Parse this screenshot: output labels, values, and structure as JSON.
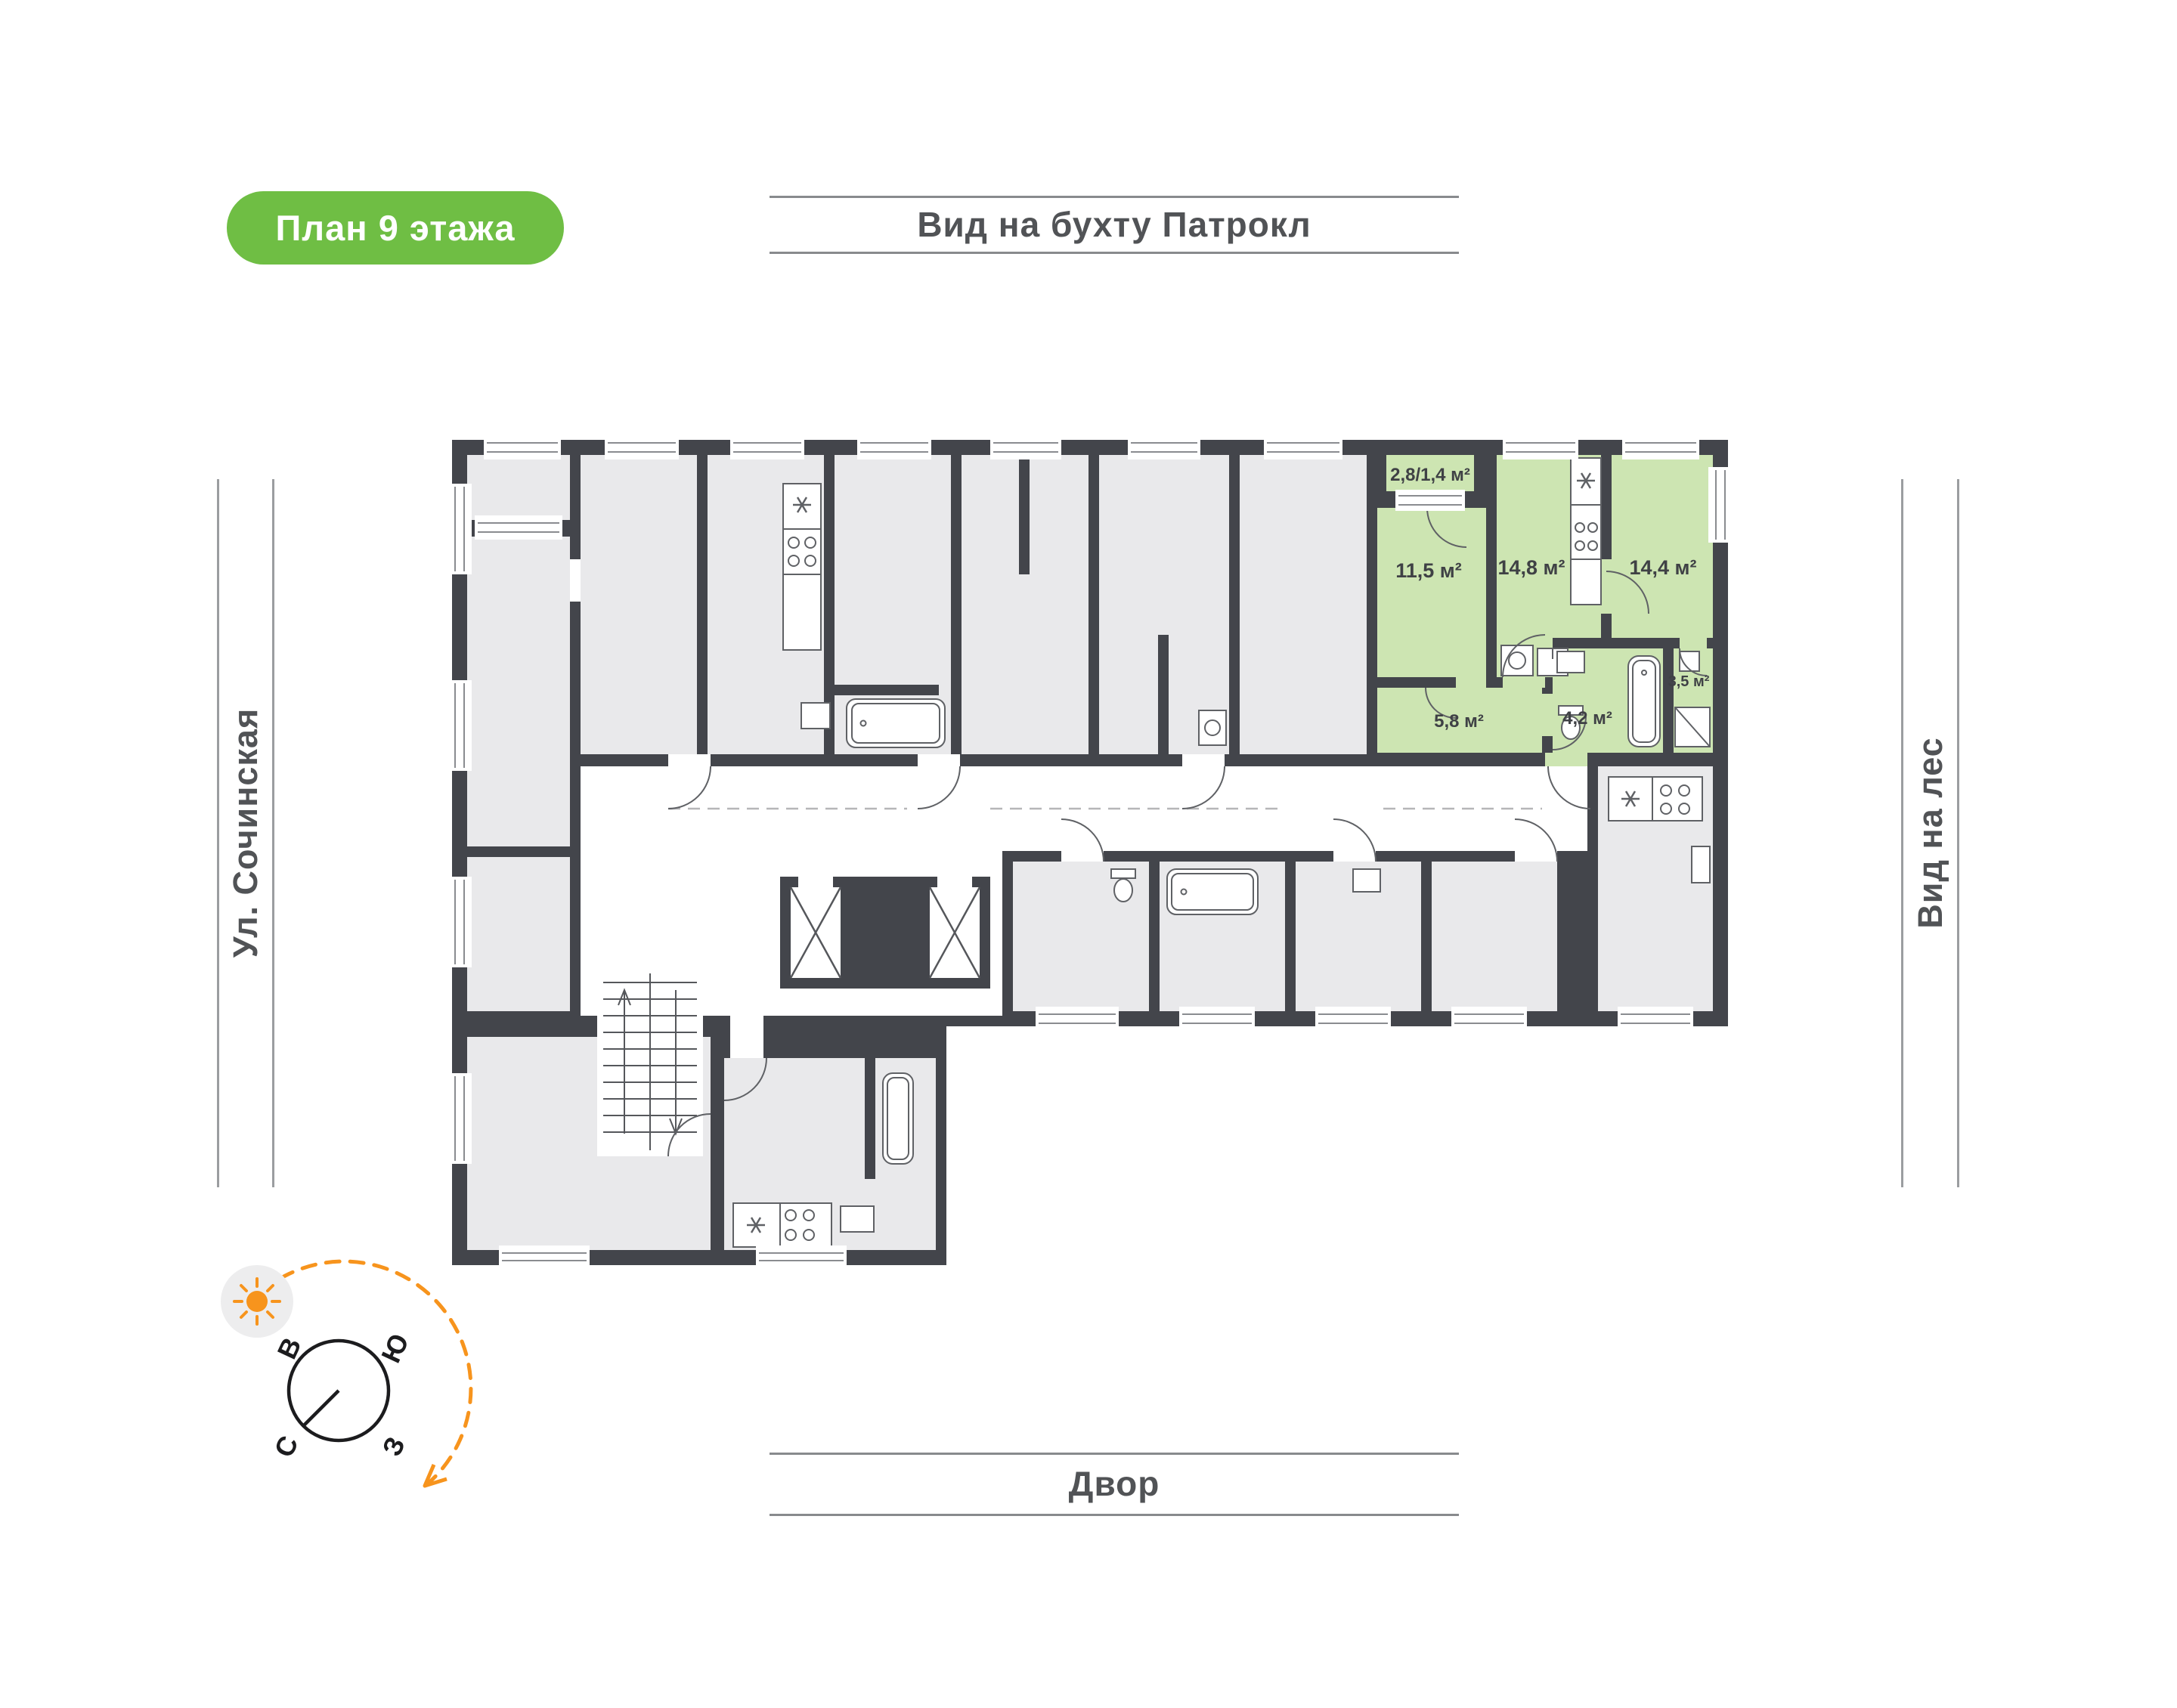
{
  "title_badge": {
    "label": "План 9 этажа"
  },
  "orientation": {
    "top": "Вид на бухту Патрокл",
    "left": "Ул. Сочинская",
    "right": "Вид на лес",
    "bottom": "Двор"
  },
  "compass": {
    "east": "В",
    "south": "Ю",
    "north": "С",
    "west": "З"
  },
  "unit": {
    "status": "highlighted",
    "rooms": [
      {
        "name": "balcony",
        "area_label": "2,8/1,4 м²"
      },
      {
        "name": "living-room",
        "area_label": "11,5 м²"
      },
      {
        "name": "kitchen",
        "area_label": "14,8 м²"
      },
      {
        "name": "bedroom",
        "area_label": "14,4 м²"
      },
      {
        "name": "hallway",
        "area_label": "5,8 м²"
      },
      {
        "name": "bathroom",
        "area_label": "4,2 м²"
      },
      {
        "name": "shower-room",
        "area_label": "3,5 м²"
      }
    ]
  },
  "palette": {
    "badge_green": "#6fbe44",
    "unit_green": "#cde5b2",
    "wall": "#43454b",
    "room_gray": "#e9e9eb",
    "accent_orange": "#f7941d",
    "label_gray": "#515356"
  }
}
